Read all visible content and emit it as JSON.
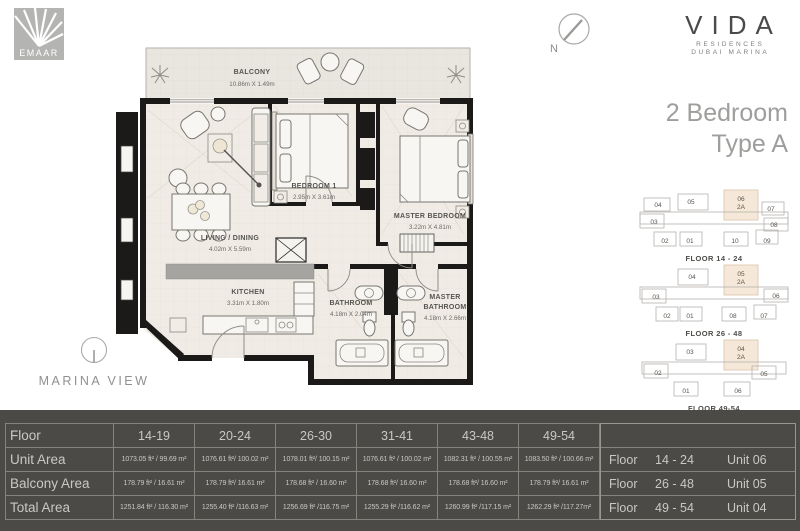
{
  "branding": {
    "emaar": "EMAAR",
    "vida": "VIDA",
    "vida_sub1": "RESIDENCES",
    "vida_sub2": "DUBAI MARINA",
    "title_line1": "2 Bedroom",
    "title_line2": "Type A",
    "marina_view": "MARINA VIEW",
    "north": "N"
  },
  "floorplan": {
    "balcony": {
      "name": "BALCONY",
      "dims": "10.86m X 1.49m"
    },
    "living": {
      "name": "LIVING / DINING",
      "dims": "4.02m X 5.59m"
    },
    "bedroom1": {
      "name": "BEDROOM 1",
      "dims": "2.95m X 3.61m"
    },
    "master_bedroom": {
      "name": "MASTER BEDROOM",
      "dims": "3.22m X 4.81m"
    },
    "kitchen": {
      "name": "KITCHEN",
      "dims": "3.31m X 1.80m"
    },
    "bathroom": {
      "name": "BATHROOM",
      "dims": "4.18m X 2.04m"
    },
    "master_bathroom": {
      "name1": "MASTER",
      "name2": "BATHROOM",
      "dims": "4.18m X 2.66m"
    }
  },
  "keyplans": [
    {
      "caption": "FLOOR 14 - 24",
      "highlight": {
        "num": "06",
        "type": "2A"
      },
      "top": [
        "04",
        "05"
      ],
      "top_right": "07",
      "left": "03",
      "right": "08",
      "bottom": [
        "02",
        "01",
        "10",
        "09"
      ]
    },
    {
      "caption": "FLOOR 26 - 48",
      "highlight": {
        "num": "05",
        "type": "2A"
      },
      "top": [
        "04"
      ],
      "left": "03",
      "right": "06",
      "bottom": [
        "02",
        "01",
        "08",
        "07"
      ]
    },
    {
      "caption": "FLOOR 49-54",
      "highlight": {
        "num": "04",
        "type": "2A"
      },
      "top": [
        "03"
      ],
      "left": "02",
      "right": "05",
      "bottom": [
        "01",
        "06"
      ]
    }
  ],
  "area_table": {
    "header": {
      "label": "Floor",
      "cols": [
        "14-19",
        "20-24",
        "26-30",
        "31-41",
        "43-48",
        "49-54"
      ]
    },
    "rows": [
      {
        "label": "Unit Area",
        "values": [
          "1073.05 ft² / 99.69 m²",
          "1076.61 ft²/ 100.02 m²",
          "1078.01 ft²/ 100.15 m²",
          "1076.61 ft² / 100.02 m²",
          "1082.31 ft² / 100.55 m²",
          "1083.50 ft² / 100.66 m²"
        ]
      },
      {
        "label": "Balcony Area",
        "values": [
          "178.79 ft² / 16.61 m²",
          "178.79 ft²/ 16.61 m²",
          "178.68 ft² / 16.60 m²",
          "178.68 ft²/ 16.60 m²",
          "178.68 ft²/ 16.60 m²",
          "178.79 ft²/ 16.61 m²"
        ]
      },
      {
        "label": "Total Area",
        "values": [
          "1251.84 ft² / 116.30 m²",
          "1255.40 ft² /116.63 m²",
          "1256.69 ft² /116.75 m²",
          "1255.29 ft² /116.62 m²",
          "1260.99 ft² /117.15 m²",
          "1262.29 ft² /117.27m²"
        ]
      }
    ]
  },
  "unit_table": {
    "rows": [
      {
        "label": "Floor",
        "range": "14 - 24",
        "unit": "Unit 06"
      },
      {
        "label": "Floor",
        "range": "26 - 48",
        "unit": "Unit 05"
      },
      {
        "label": "Floor",
        "range": "49 - 54",
        "unit": "Unit 04"
      }
    ]
  },
  "colors": {
    "band_bg": "#4b4a46",
    "highlight_unit": "#f6e8d8",
    "wall": "#1b1a18",
    "floor": "#f0ece5",
    "balcony_floor": "#e9e5df"
  }
}
